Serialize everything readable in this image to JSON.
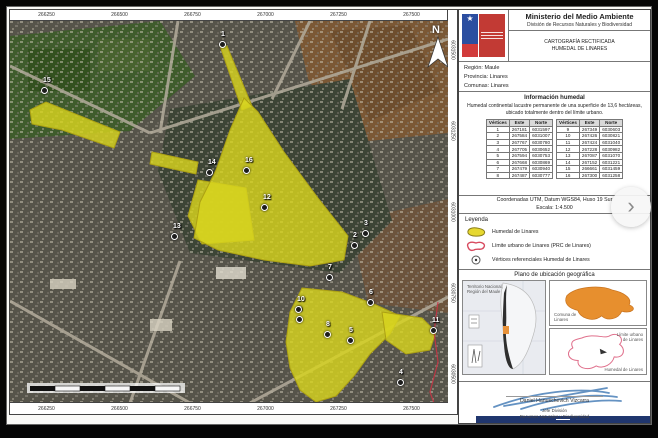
{
  "viewer": {
    "next_icon": "›"
  },
  "map": {
    "north_label": "N",
    "este_ticks": [
      "266250",
      "266500",
      "266750",
      "267000",
      "267250",
      "267500"
    ],
    "norte_ticks": [
      "6031500",
      "6031250",
      "6031000",
      "6030750",
      "6030500"
    ],
    "vertices": [
      {
        "n": "1",
        "x": 212,
        "y": 23
      },
      {
        "n": "2",
        "x": 344,
        "y": 224
      },
      {
        "n": "3",
        "x": 355,
        "y": 212
      },
      {
        "n": "4",
        "x": 390,
        "y": 361
      },
      {
        "n": "5",
        "x": 340,
        "y": 319
      },
      {
        "n": "6",
        "x": 360,
        "y": 281
      },
      {
        "n": "7",
        "x": 319,
        "y": 256
      },
      {
        "n": "8",
        "x": 317,
        "y": 313
      },
      {
        "n": "9",
        "x": 289,
        "y": 298
      },
      {
        "n": "10",
        "x": 288,
        "y": 288
      },
      {
        "n": "11",
        "x": 423,
        "y": 309
      },
      {
        "n": "12",
        "x": 254,
        "y": 186
      },
      {
        "n": "13",
        "x": 164,
        "y": 215
      },
      {
        "n": "14",
        "x": 199,
        "y": 151
      },
      {
        "n": "15",
        "x": 34,
        "y": 69
      },
      {
        "n": "16",
        "x": 236,
        "y": 149
      }
    ]
  },
  "panel": {
    "ministry": "Ministerio del Medio Ambiente",
    "division": "División de Recursos Naturales y Biodiversidad",
    "doc_line1": "CARTOGRAFÍA RECTIFICADA",
    "doc_line2": "HUMEDAL DE LINARES",
    "region": "Región: Maule",
    "provincia": "Provincia: Linares",
    "comunas": "Comunas: Linares",
    "info_title": "Información humedal",
    "info_text": "Humedal continental lacustre permanente de una superficie de 13,6 hectáreas, ubicado totalmente dentro del límite urbano.",
    "table": {
      "headers": [
        "Vértices",
        "Este",
        "Norte"
      ],
      "rows_left": [
        [
          "1",
          "267181",
          "6031597"
        ],
        [
          "2",
          "267584",
          "6031007"
        ],
        [
          "3",
          "267767",
          "6030780"
        ],
        [
          "4",
          "267705",
          "6030652"
        ],
        [
          "5",
          "267594",
          "6030753"
        ],
        [
          "6",
          "267668",
          "6030869"
        ],
        [
          "7",
          "267479",
          "6030940"
        ],
        [
          "8",
          "267487",
          "6030777"
        ]
      ],
      "rows_right": [
        [
          "9",
          "267349",
          "6030603"
        ],
        [
          "10",
          "267426",
          "6030821"
        ],
        [
          "11",
          "267424",
          "6031040"
        ],
        [
          "12",
          "267228",
          "6030982"
        ],
        [
          "13",
          "267087",
          "6031070"
        ],
        [
          "14",
          "267152",
          "6031221"
        ],
        [
          "15",
          "266661",
          "6031459"
        ],
        [
          "16",
          "267300",
          "6031258"
        ]
      ]
    },
    "coords_note": "Coordenadas UTM, Datum WGS84, Huso 19 Sur",
    "scale_note": "Escala: 1:4.500",
    "legend": {
      "title": "Leyenda",
      "items": [
        "Humedal de Linares",
        "Límite urbano de Linares (PRC de Linares)",
        "Vértices referenciales Humedal de Linares"
      ]
    },
    "location": {
      "title": "Plano de ubicación geográfica",
      "chile_label_1": "Territorio Nacional,",
      "chile_label_2": "Región del Maule",
      "comuna_label_1": "Comuna de",
      "comuna_label_2": "Linares",
      "limite_label": "Límite urbano de Linares",
      "humedal_label": "Humedal de Linares"
    },
    "signature": {
      "name": "Daniel Hanuschevich Vizcarra",
      "role1": "Jefe División",
      "role2": "Recursos Naturales y Biodiversidad"
    }
  },
  "colors": {
    "wetland_fill": "#d8d41f",
    "wetland_stroke": "#aca013",
    "urban_limit": "#d84a5f",
    "comuna_fill": "#e78f2e",
    "logo_blue": "#2b4ea0",
    "logo_red": "#c23a34"
  }
}
